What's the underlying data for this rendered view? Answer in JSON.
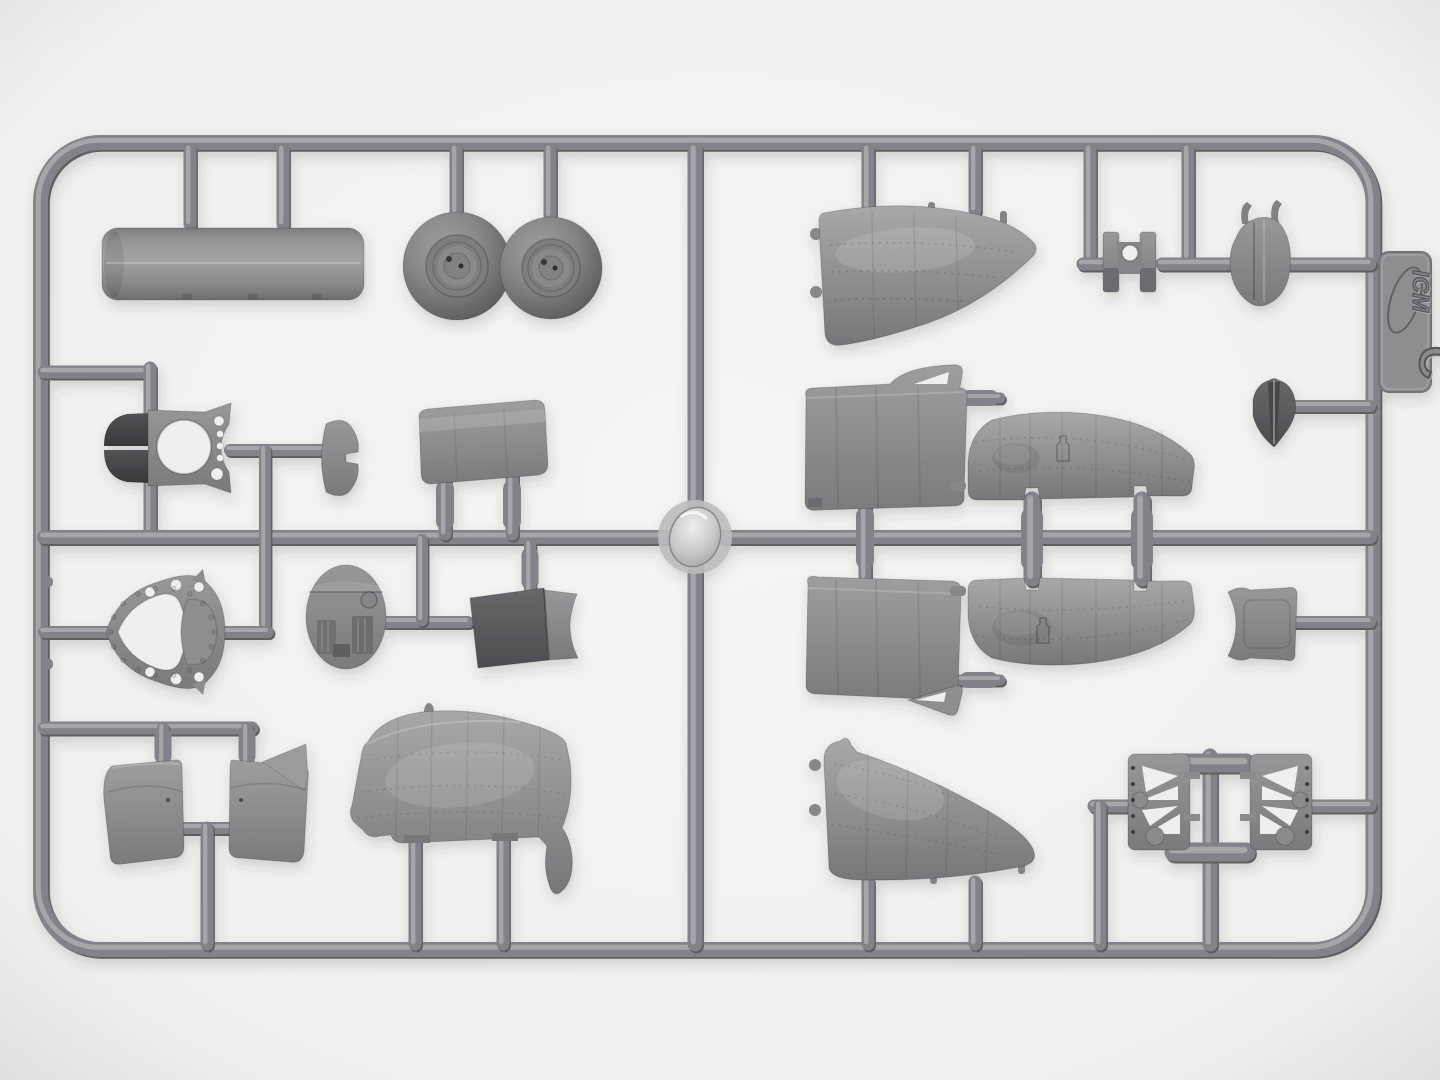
{
  "scene": {
    "description": "Photograph of a gray injection-molded plastic model kit sprue (parts frame) lying on a white surface",
    "background_color": "#f2f0ee",
    "plastic_color": "#82828a",
    "plastic_highlight": "#a6a6a8",
    "plastic_shadow": "#5e5e61",
    "gate_hub_color": "#d9d9db"
  },
  "sprue": {
    "brand": "ICM",
    "sprue_letter": "C"
  },
  "parts": [
    {
      "id": "exhaust-tube",
      "label": "Cylindrical tube"
    },
    {
      "id": "main-wheel-left",
      "label": "Wheel with hub detail"
    },
    {
      "id": "main-wheel-right",
      "label": "Wheel with hub detail"
    },
    {
      "id": "engine-firewall",
      "label": "Bulkhead with round opening and split air intake"
    },
    {
      "id": "cowl-flap",
      "label": "Small arched flap"
    },
    {
      "id": "cradle-panel",
      "label": "Curved saddle panel"
    },
    {
      "id": "instrument-panel",
      "label": "Oval panel with ribbed boxes"
    },
    {
      "id": "mount-ring",
      "label": "Teardrop mounting ring with lightening holes"
    },
    {
      "id": "seat-pan",
      "label": "Seat pan with concave edge"
    },
    {
      "id": "nose-panel-upper",
      "label": "Riveted wedge fuselage panel"
    },
    {
      "id": "cowl-section-upper",
      "label": "Curved cowl section with bracket"
    },
    {
      "id": "cowl-section-lower",
      "label": "Curved cowl section with bracket"
    },
    {
      "id": "stabilizer-upper",
      "label": "Stabilizer half with fabric detail"
    },
    {
      "id": "stabilizer-lower",
      "label": "Stabilizer half with fabric detail"
    },
    {
      "id": "fin-fairing",
      "label": "Small grooved teardrop fairing"
    },
    {
      "id": "headrest",
      "label": "Small curved backrest"
    },
    {
      "id": "engine-block",
      "label": "H-shaped block with hole"
    },
    {
      "id": "shell-fairing",
      "label": "Rounded shell with two hooks"
    },
    {
      "id": "gear-truss-left",
      "label": "Lattice landing-gear truss"
    },
    {
      "id": "gear-truss-right",
      "label": "Lattice landing-gear truss"
    },
    {
      "id": "cowl-half-left",
      "label": "Cowling half"
    },
    {
      "id": "cowl-half-right",
      "label": "Cowling half"
    },
    {
      "id": "nose-panel-side",
      "label": "Curved fuselage nose panel with drip tip"
    },
    {
      "id": "nose-panel-lower",
      "label": "Riveted wedge fuselage panel"
    }
  ]
}
